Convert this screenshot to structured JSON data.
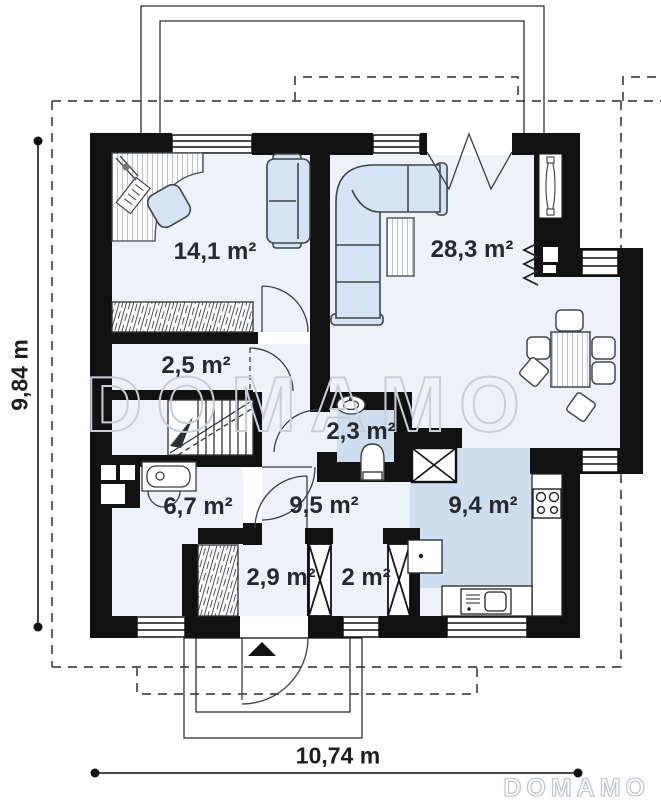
{
  "plan": {
    "rooms": {
      "bedroom": {
        "label": "14,1 m²"
      },
      "living": {
        "label": "28,3 m²"
      },
      "corridor": {
        "label": "2,5 m²"
      },
      "wc": {
        "label": "2,3 m²"
      },
      "utility": {
        "label": "6,7 m²"
      },
      "hall": {
        "label": "9,5 m²"
      },
      "kitchen": {
        "label": "9,4 m²"
      },
      "vestibule": {
        "label": "2,9 m²"
      },
      "closet": {
        "label": "2 m²"
      }
    },
    "dimensions": {
      "height": "9,84 m",
      "width": "10,74 m"
    },
    "watermark": {
      "center": "DOMAMO",
      "corner": "DOMAMO"
    },
    "colors": {
      "wall": "#111111",
      "floor": "#edf2f9",
      "wet_floor": "#cfdeef",
      "furniture": "#d6e3f5",
      "watermark": "#c9ced6"
    }
  }
}
